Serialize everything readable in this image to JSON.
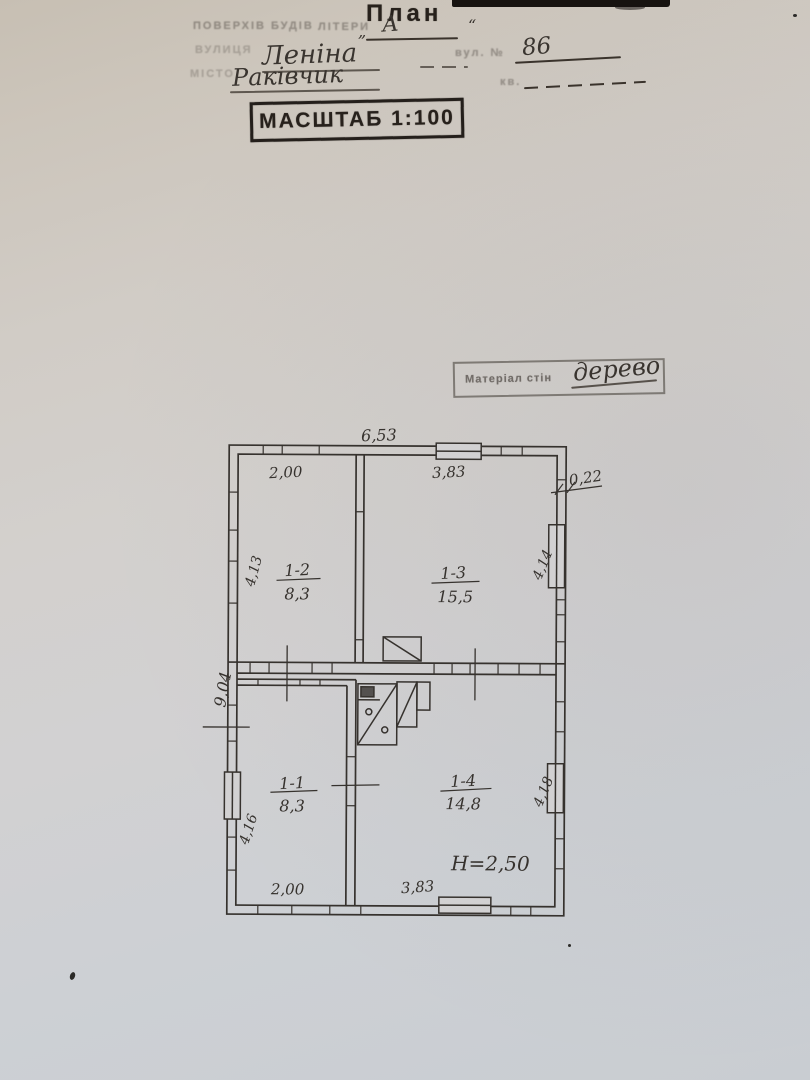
{
  "page": {
    "title": "План",
    "form": {
      "line1_label": "ПОВЕРХІВ БУДІВ",
      "line1_mid": "ЛІТЕРИ",
      "line1_open_quote": "„",
      "line1_value": "А",
      "line1_close_quote": "“",
      "line2_label": "ВУЛИЦЯ",
      "line2_value": "Леніна",
      "line2_right_label": "вул. №",
      "line2_right_value": "86",
      "line3_label": "МІСТО",
      "line3_value": "Раківчик",
      "line3_right_label": "кв."
    },
    "scale_stamp": "МАСШТАБ 1:100",
    "material_label": "Матеріал  стін",
    "material_value": "дерево"
  },
  "plan": {
    "rooms": [
      {
        "id": "1-2",
        "area": "8,3"
      },
      {
        "id": "1-3",
        "area": "15,5"
      },
      {
        "id": "1-1",
        "area": "8,3"
      },
      {
        "id": "1-4",
        "area": "14,8"
      }
    ],
    "dims": {
      "top_overall": "6,53",
      "top_left": "2,00",
      "top_right": "3,83",
      "wall_thickness": "0,22",
      "left_upper": "4,13",
      "right_upper": "4,14",
      "left_overall": "9,04",
      "left_lower": "4,16",
      "right_lower": "4,18",
      "bottom_left": "2,00",
      "bottom_right": "3,83",
      "height_note": "H=2,50"
    }
  },
  "colors": {
    "paper": "#d1cdc8",
    "ink_stamp": "#27211c",
    "ink_hand": "#39342f",
    "plan_line": "#36322e"
  }
}
